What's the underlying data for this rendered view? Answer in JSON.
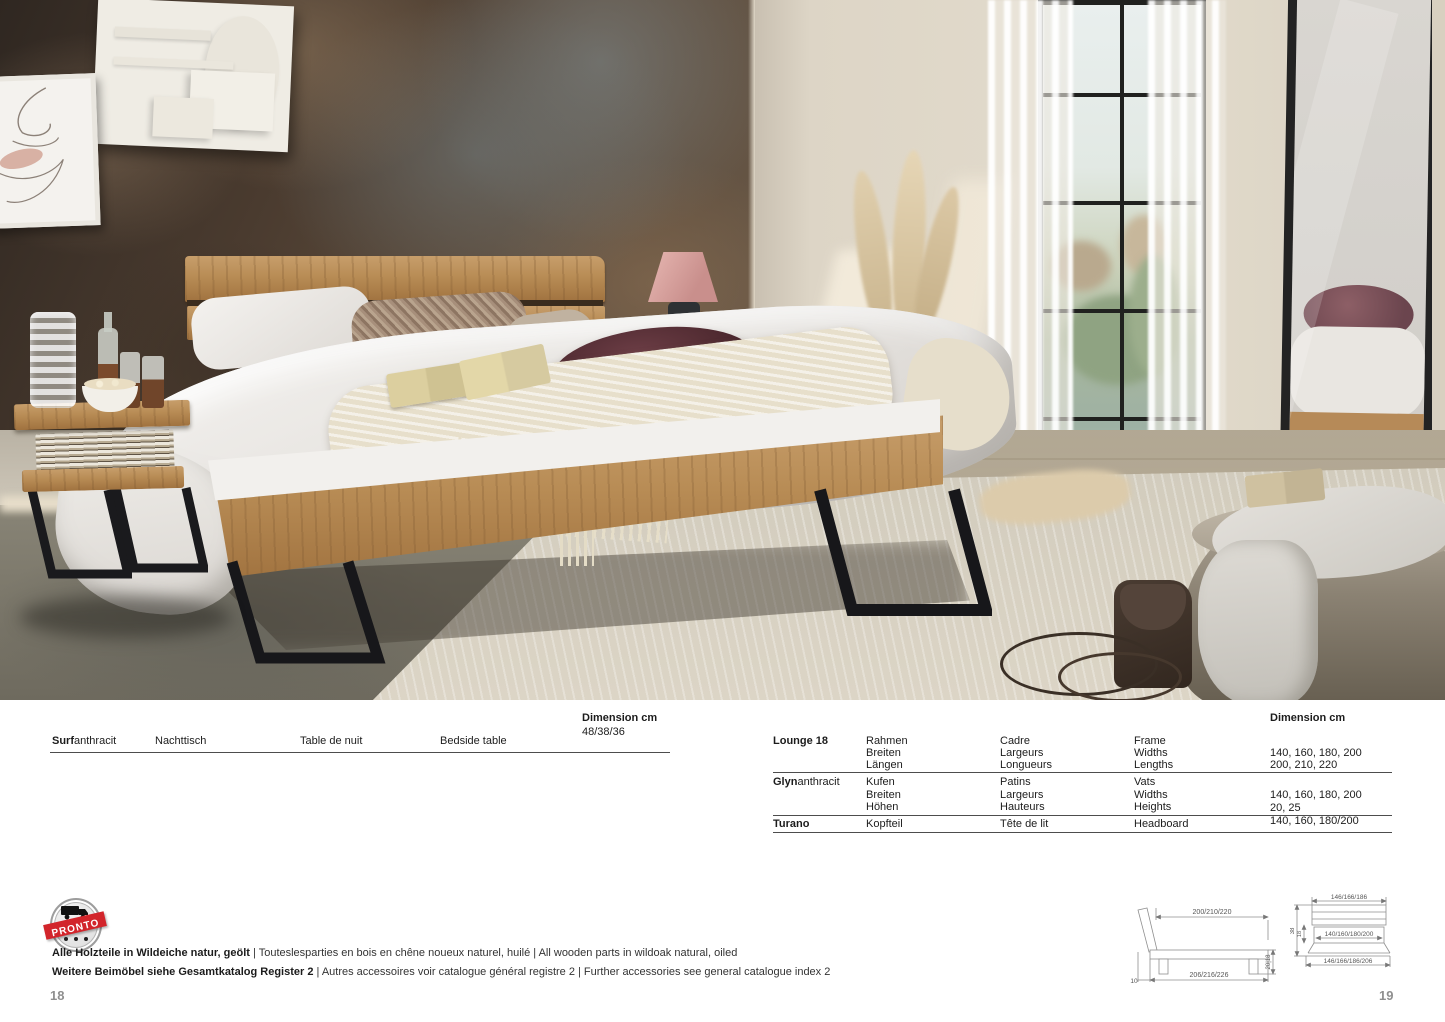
{
  "left_table": {
    "header_label": "Dimension cm",
    "header_value": "48/38/36",
    "product": "Surf",
    "variant": "anthracit",
    "name_de": "Nachttisch",
    "name_fr": "Table de nuit",
    "name_en": "Bedside table"
  },
  "right_table": {
    "header_label": "Dimension cm",
    "groups": [
      {
        "name": "Lounge 18",
        "variant": "",
        "lines": [
          {
            "de": "Rahmen",
            "fr": "Cadre",
            "en": "Frame",
            "val": ""
          },
          {
            "de": "Breiten",
            "fr": "Largeurs",
            "en": "Widths",
            "val": "140, 160, 180, 200"
          },
          {
            "de": "Längen",
            "fr": "Longueurs",
            "en": "Lengths",
            "val": "200, 210, 220"
          }
        ]
      },
      {
        "name": "Glyn",
        "variant": "anthracit",
        "lines": [
          {
            "de": "Kufen",
            "fr": "Patins",
            "en": "Vats",
            "val": ""
          },
          {
            "de": "Breiten",
            "fr": "Largeurs",
            "en": "Widths",
            "val": "140, 160, 180, 200"
          },
          {
            "de": "Höhen",
            "fr": "Hauteurs",
            "en": "Heights",
            "val": "20, 25"
          }
        ]
      },
      {
        "name": "Turano",
        "variant": "",
        "lines": [
          {
            "de": "Kopfteil",
            "fr": "Tête de lit",
            "en": "Headboard",
            "val": "140, 160, 180/200"
          }
        ]
      }
    ]
  },
  "stamp": {
    "label": "PRONTO"
  },
  "footer": {
    "line1_bold": "Alle Holzteile in Wildeiche natur, geölt",
    "line1_rest": "  | Touteslesparties en bois en chêne noueux naturel, huilé | All wooden parts in wildoak natural, oiled",
    "line2_bold": "Weitere Beimöbel siehe Gesamtkatalog Register 2",
    "line2_rest": "  | Autres accessoires voir catalogue général registre 2 | Further accessories see general catalogue index 2"
  },
  "diagrams": {
    "side": {
      "top": "200/210/220",
      "bottom": "206/216/226",
      "right": "20|18",
      "left": "10"
    },
    "front": {
      "top": "146/166/186",
      "middle": "140/160/180/200",
      "bottom": "146/166/186/206",
      "left": "38",
      "inner": "18"
    }
  },
  "page_numbers": {
    "left": "18",
    "right": "19"
  }
}
